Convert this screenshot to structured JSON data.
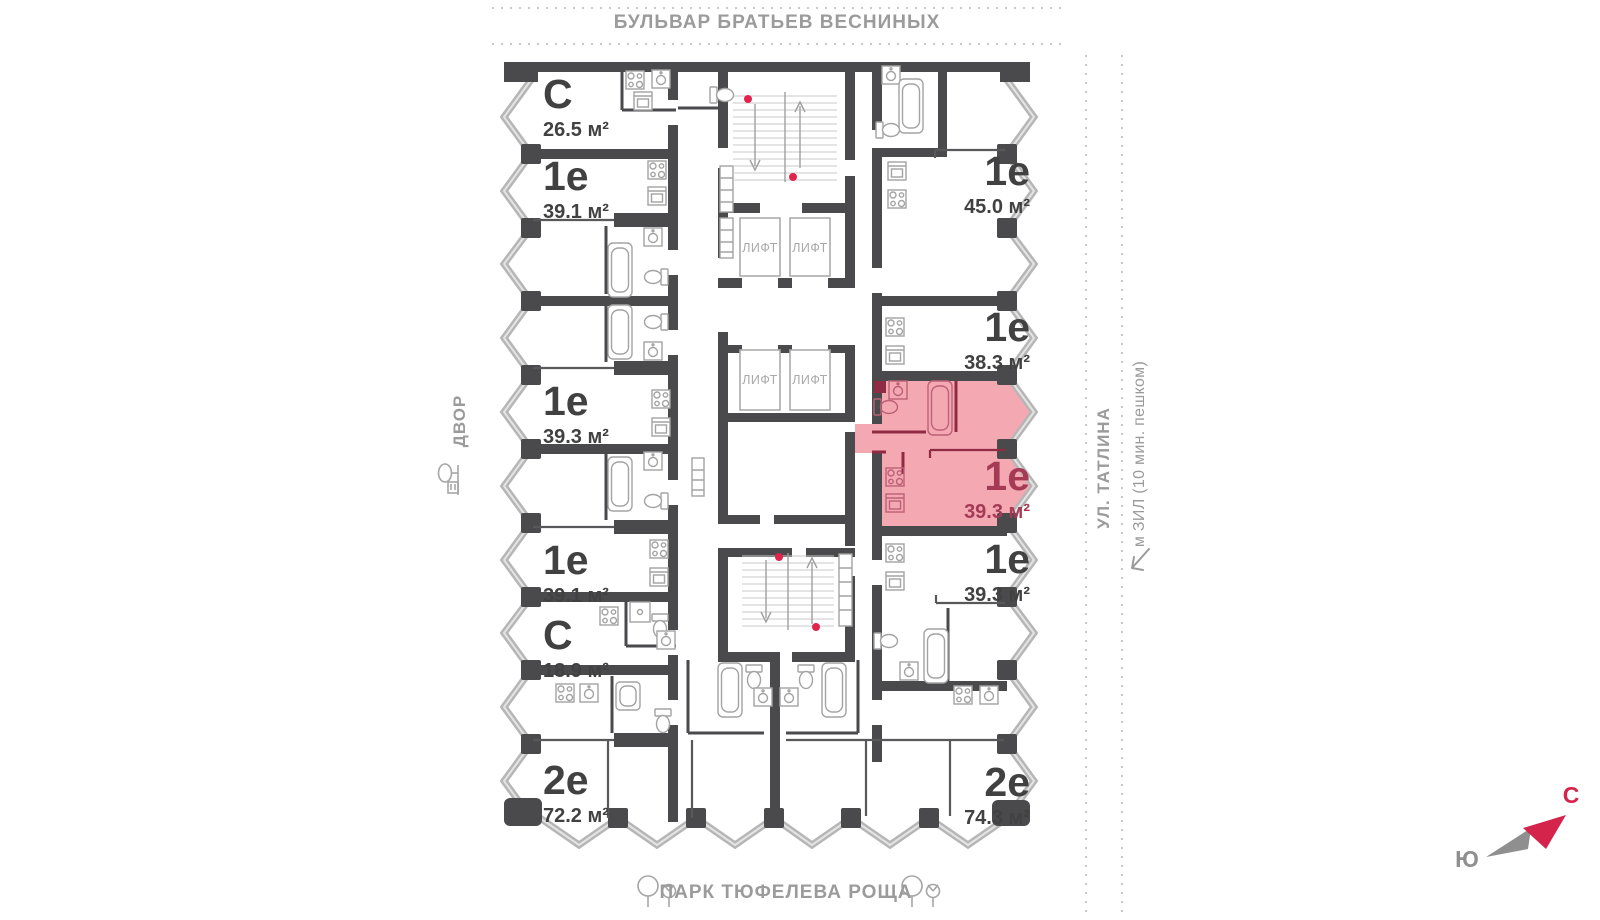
{
  "streets": {
    "top": "БУЛЬВАР БРАТЬЕВ ВЕСНИНЫХ",
    "left": "ДВОР",
    "right": "УЛ. ТАТЛИНА",
    "right_metro": "м ЗИЛ (10 мин. пешком)",
    "bottom": "ПАРК ТЮФЕЛЕВА РОЩА"
  },
  "compass": {
    "north": "С",
    "south": "Ю"
  },
  "labels": {
    "lift": "ЛИФТ"
  },
  "apartments": [
    {
      "id": "left-1",
      "type": "С",
      "area": "26.5 м²",
      "highlighted": false
    },
    {
      "id": "left-2",
      "type": "1е",
      "area": "39.1 м²",
      "highlighted": false
    },
    {
      "id": "left-3",
      "type": "1е",
      "area": "39.3 м²",
      "highlighted": false
    },
    {
      "id": "left-4",
      "type": "1е",
      "area": "39.1 м²",
      "highlighted": false
    },
    {
      "id": "left-5",
      "type": "С",
      "area": "18.9 м²",
      "highlighted": false
    },
    {
      "id": "left-6",
      "type": "2е",
      "area": "72.2 м²",
      "highlighted": false
    },
    {
      "id": "right-1",
      "type": "1е",
      "area": "45.0 м²",
      "highlighted": false
    },
    {
      "id": "right-2",
      "type": "1е",
      "area": "38.3 м²",
      "highlighted": false
    },
    {
      "id": "right-3",
      "type": "1е",
      "area": "39.3 м²",
      "highlighted": true
    },
    {
      "id": "right-4",
      "type": "1е",
      "area": "39.3 м²",
      "highlighted": false
    },
    {
      "id": "right-5",
      "type": "2е",
      "area": "74.3 м²",
      "highlighted": false
    }
  ],
  "colors": {
    "highlight_fill": "#f4a8b2",
    "highlight_text": "#a53a55",
    "wall": "#4a4a4c",
    "accent_red": "#d5244b",
    "muted_text": "#9b9b9b"
  }
}
